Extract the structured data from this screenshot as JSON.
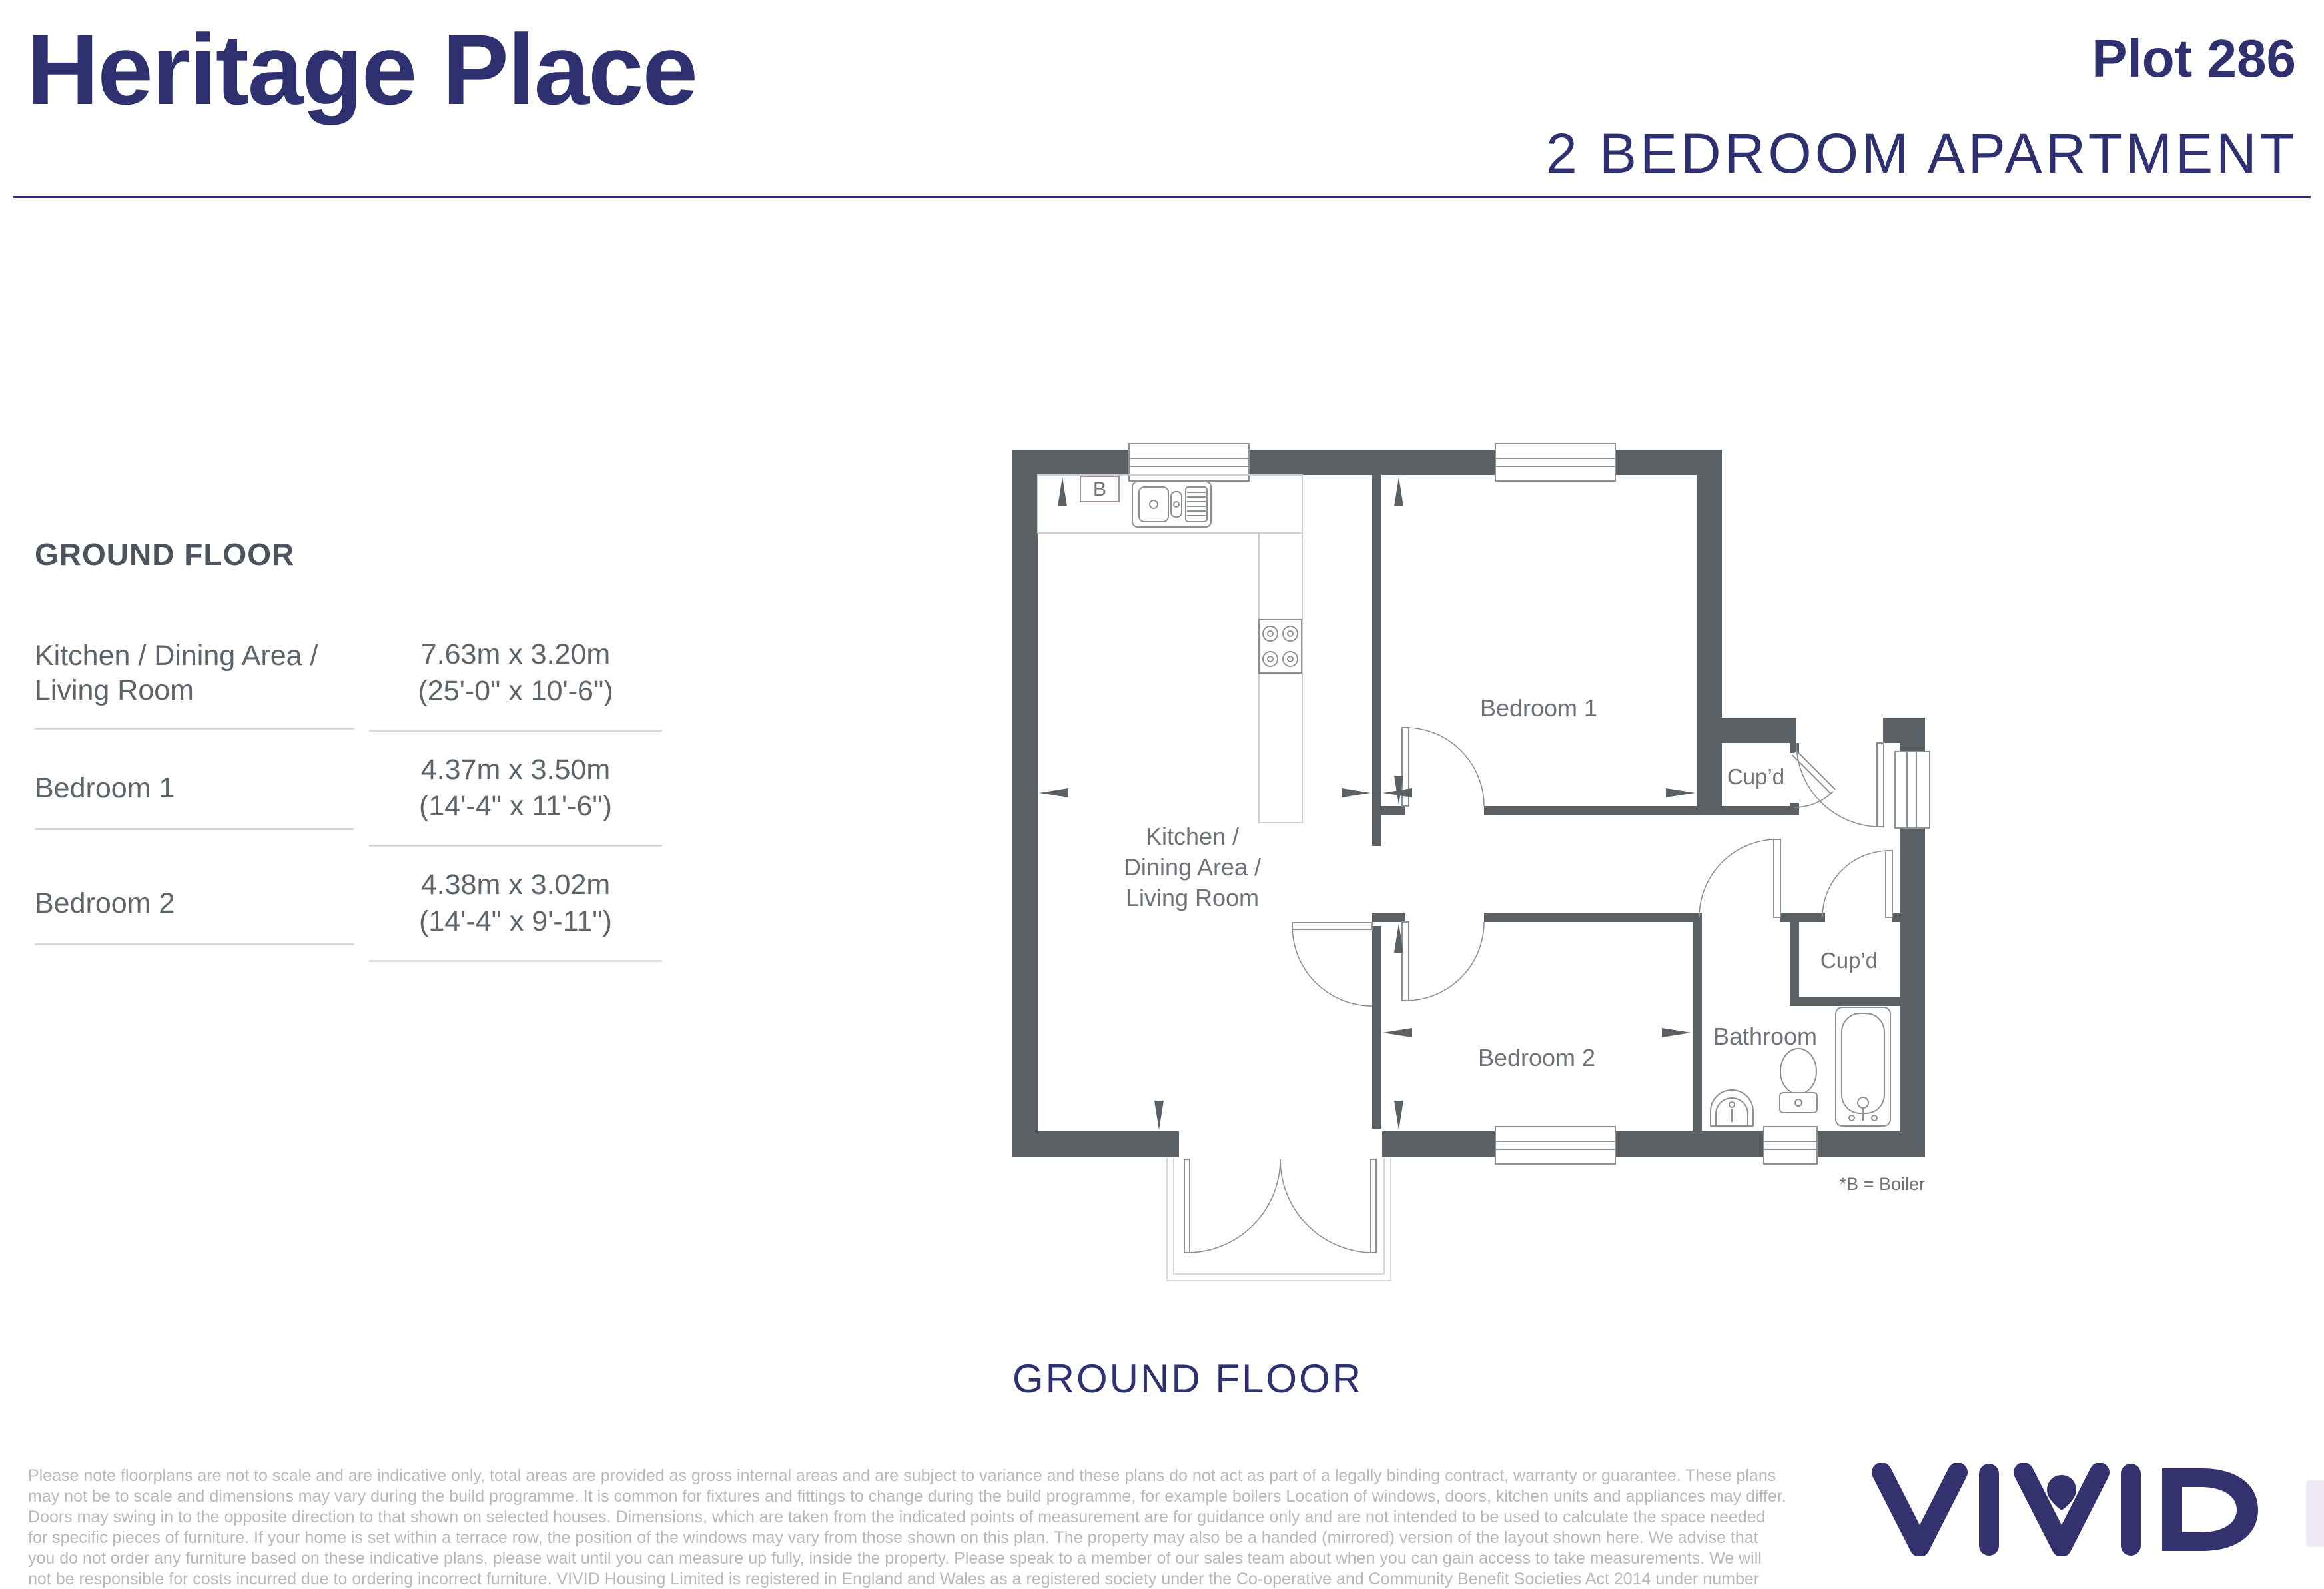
{
  "header": {
    "title": "Heritage Place",
    "plot": "Plot 286",
    "subtitle": "2 BEDROOM APARTMENT"
  },
  "schedule": {
    "title": "GROUND FLOOR",
    "rows": [
      {
        "name": "Kitchen / Dining Area / Living Room",
        "metric": "7.63m x 3.20m",
        "imperial": "(25'-0\" x 10'-6\")"
      },
      {
        "name": "Bedroom 1",
        "metric": "4.37m x 3.50m",
        "imperial": "(14'-4\" x 11'-6\")"
      },
      {
        "name": "Bedroom 2",
        "metric": "4.38m x 3.02m",
        "imperial": "(14'-4\" x 9'-11\")"
      }
    ]
  },
  "plan": {
    "caption": "GROUND FLOOR",
    "boiler_note": "*B = Boiler",
    "boiler_label": "B",
    "rooms": {
      "bedroom1": "Bedroom 1",
      "bedroom2": "Bedroom 2",
      "cupboard1": "Cup’d",
      "cupboard2": "Cup’d",
      "bathroom": "Bathroom",
      "kitchen_lines": [
        "Kitchen /",
        "Dining Area /",
        "Living Room"
      ]
    }
  },
  "footer": {
    "logo": "VIVID",
    "disclaimer": "Please note floorplans are not to scale and are indicative only, total areas are provided as gross internal areas and are subject to variance and these plans do not act as part of a legally binding contract, warranty or guarantee. These plans may not be to scale and dimensions may vary during the build programme. It is common for fixtures and fittings to change during the build programme, for example boilers Location of windows, doors, kitchen units and appliances may differ. Doors may swing in to the opposite direction to that shown on selected houses. Dimensions, which are taken from the indicated points of measurement are for guidance only and are not intended to be used to calculate the space needed for specific pieces of furniture. If your home is set within a terrace row, the position of the windows may vary from those shown on this plan. The property may also be a handed (mirrored) version of the layout shown here. We advise that you do not order any furniture based on these indicative plans, please wait until you can measure up fully, inside the property. Please speak to a member of our sales team about when you can gain access to take measurements. We will not be responsible for costs incurred due to ordering incorrect furniture. VIVID Housing Limited is registered in England and Wales as a registered society under the Co-operative and Community Benefit Societies Act 2014 under number 7544 with exempt charity status and as a registered provider of social housing with the Regulator of Social Housing under number 4850. Our registered office is at Peninsular House, Wharf Road, Portsmouth, Hampshire, PO2 8HB. All information correct at time of creation - September 2025."
  },
  "colors": {
    "navy": "#2f3070",
    "wall_gray": "#5b6065",
    "room_text": "#6d7378",
    "schedule_text": "#5d646a",
    "line_gray": "#8b9094",
    "separator": "#d9dbdd",
    "disclaimer_text": "#b6b9bc"
  }
}
